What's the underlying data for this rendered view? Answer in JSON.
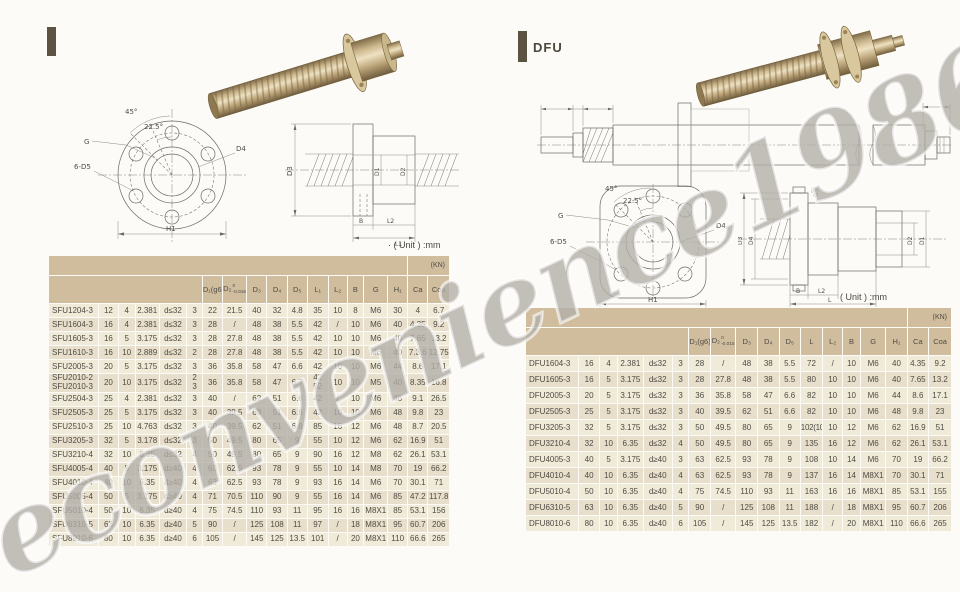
{
  "watermark": {
    "text": "econvenience1986"
  },
  "left_panel": {
    "unit_label": "· ( Unit ) :mm",
    "flange_drawing": {
      "angle_45": "45°",
      "angle_22_5": "22.5°",
      "g_label": "G",
      "holes_label": "6-D5",
      "d4_label": "D4",
      "h1_label": "H1"
    },
    "section_drawing": {
      "d3_label": "D3",
      "d1_label": "D1",
      "d2_label": "D2",
      "b_label": "B",
      "l2_label": "L2",
      "l1_label": "L1"
    },
    "table": {
      "kn_label": "(KN)",
      "columns": [
        "D₁(g6)",
        "D₂",
        "D₃",
        "D₄",
        "D₅",
        "L₁",
        "L₂",
        "B",
        "G",
        "H₁",
        "Ca",
        "Coa"
      ],
      "d2_tolerance": {
        "top": "0",
        "bottom": "-0.015"
      },
      "rows": [
        [
          "SFU1204-3",
          "12",
          "4",
          "2.381",
          "d≤32",
          "3",
          "22",
          "21.5",
          "40",
          "32",
          "4.8",
          "35",
          "10",
          "8",
          "M6",
          "30",
          "4",
          "6.7"
        ],
        [
          "SFU1604-3",
          "16",
          "4",
          "2.381",
          "d≤32",
          "3",
          "28",
          "/",
          "48",
          "38",
          "5.5",
          "42",
          "/",
          "10",
          "M6",
          "40",
          "4.35",
          "9.2"
        ],
        [
          "SFU1605-3",
          "16",
          "5",
          "3.175",
          "d≤32",
          "3",
          "28",
          "27.8",
          "48",
          "38",
          "5.5",
          "42",
          "10",
          "10",
          "M6",
          "40",
          "7.65",
          "13.2"
        ],
        [
          "SFU1610-3",
          "16",
          "10",
          "2.889",
          "d≤32",
          "2",
          "28",
          "27.8",
          "48",
          "38",
          "5.5",
          "42",
          "10",
          "10",
          "M6",
          "40",
          "7.3.6",
          "12.75"
        ],
        [
          "SFU2005-3",
          "20",
          "5",
          "3.175",
          "d≤32",
          "3",
          "36",
          "35.8",
          "58",
          "47",
          "6.6",
          "42",
          "10",
          "10",
          "M6",
          "44",
          "8.6",
          "17.1"
        ],
        [
          "SFU2010-2\nSFU2010-3",
          "20",
          "10",
          "3.175",
          "d≤32",
          "2\n3",
          "36",
          "35.8",
          "58",
          "47",
          "6.7",
          "42\n52",
          "10",
          "10",
          "M5",
          "40",
          "8.35",
          "16.8"
        ],
        [
          "SFU2504-3",
          "25",
          "4",
          "2.381",
          "d≤32",
          "3",
          "40",
          "/",
          "62",
          "51",
          "6.6",
          "42",
          "/",
          "10",
          "M6",
          "48",
          "9.1",
          "26.5"
        ],
        [
          "SFU2505-3",
          "25",
          "5",
          "3.175",
          "d≤32",
          "3",
          "40",
          "39.5",
          "63",
          "51",
          "6.6",
          "42",
          "10",
          "10",
          "M6",
          "48",
          "9.8",
          "23"
        ],
        [
          "SFU2510-3",
          "25",
          "10",
          "4.763",
          "d≤32",
          "3",
          "40",
          "39.5",
          "62",
          "51",
          "6.8",
          "85",
          "16",
          "12",
          "M6",
          "48",
          "8.7",
          "20.5"
        ],
        [
          "SFU3205-3",
          "32",
          "5",
          "3.178",
          "d≤32",
          "3",
          "50",
          "49.5",
          "80",
          "65",
          "9",
          "55",
          "10",
          "12",
          "M6",
          "62",
          "16.9",
          "51"
        ],
        [
          "SFU3210-4",
          "32",
          "10",
          "6.35",
          "d≤32",
          "4",
          "50",
          "49.5",
          "80",
          "65",
          "9",
          "90",
          "16",
          "12",
          "M8",
          "62",
          "26.1",
          "53.1"
        ],
        [
          "SFU4005-4",
          "40",
          "5",
          "3.175",
          "d≥40",
          "4",
          "63",
          "62.5",
          "93",
          "78",
          "9",
          "55",
          "10",
          "14",
          "M8",
          "70",
          "19",
          "66.2"
        ],
        [
          "SFU4010-4",
          "40",
          "10",
          "6.35",
          "d≥40",
          "4",
          "63",
          "62.5",
          "93",
          "78",
          "9",
          "93",
          "16",
          "14",
          "M6",
          "70",
          "30.1",
          "71"
        ],
        [
          "SFU5005-4",
          "50",
          "5",
          "3.175",
          "d≥40",
          "4",
          "71",
          "70.5",
          "110",
          "90",
          "9",
          "55",
          "16",
          "14",
          "M6",
          "85",
          "47.2",
          "117.8"
        ],
        [
          "SFU5010-4",
          "50",
          "10",
          "6.35",
          "d≥40",
          "4",
          "75",
          "74.5",
          "110",
          "93",
          "11",
          "95",
          "16",
          "16",
          "M8X1",
          "85",
          "53.1",
          "156"
        ],
        [
          "SFU6310-5",
          "63",
          "10",
          "6.35",
          "d≥40",
          "5",
          "90",
          "/",
          "125",
          "108",
          "11",
          "97",
          "/",
          "18",
          "M8X1",
          "95",
          "60.7",
          "206"
        ],
        [
          "SFU8010-6",
          "80",
          "10",
          "6.35",
          "d≥40",
          "6",
          "105",
          "/",
          "145",
          "125",
          "13.5",
          "101",
          "/",
          "20",
          "M8X1",
          "110",
          "66.6",
          "265"
        ]
      ]
    }
  },
  "right_panel": {
    "title": "DFU",
    "unit_label": "( Unit ) :mm",
    "flange_drawing": {
      "angle_45": "45°",
      "angle_22_5": "22.5°",
      "g_label": "G",
      "holes_label": "6-D5",
      "d4_label": "D4",
      "h1_label": "H1"
    },
    "section_drawing": {
      "d3_label": "D3",
      "d4_label": "D4",
      "d5_label": "D5",
      "d2_label": "D2",
      "d1_label": "D1",
      "b_label": "B",
      "l2_label": "L2",
      "l_label": "L"
    },
    "table": {
      "kn_label": "(KN)",
      "columns": [
        "D₁(g6)",
        "D₂",
        "D₃",
        "D₄",
        "D₅",
        "L",
        "L₂",
        "B",
        "G",
        "H₁",
        "Ca",
        "Coa"
      ],
      "d2_tolerance": {
        "top": "0",
        "bottom": "-0.015"
      },
      "rows": [
        [
          "DFU1604-3",
          "16",
          "4",
          "2.381",
          "d≤32",
          "3",
          "28",
          "/",
          "48",
          "38",
          "5.5",
          "72",
          "/",
          "10",
          "M6",
          "40",
          "4.35",
          "9.2"
        ],
        [
          "DFU1605-3",
          "16",
          "5",
          "3.175",
          "d≤32",
          "3",
          "28",
          "27.8",
          "48",
          "38",
          "5.5",
          "80",
          "10",
          "10",
          "M6",
          "40",
          "7.65",
          "13.2"
        ],
        [
          "DFU2005-3",
          "20",
          "5",
          "3.175",
          "d≤32",
          "3",
          "36",
          "35.8",
          "58",
          "47",
          "6.6",
          "82",
          "10",
          "10",
          "M6",
          "44",
          "8.6",
          "17.1"
        ],
        [
          "DFU2505-3",
          "25",
          "5",
          "3.175",
          "d≤32",
          "3",
          "40",
          "39.5",
          "62",
          "51",
          "6.6",
          "82",
          "10",
          "10",
          "M6",
          "48",
          "9.8",
          "23"
        ],
        [
          "DFU3205-3",
          "32",
          "5",
          "3.175",
          "d≤32",
          "3",
          "50",
          "49.5",
          "80",
          "65",
          "9",
          "102(106)",
          "10",
          "12",
          "M6",
          "62",
          "16.9",
          "51"
        ],
        [
          "DFU3210-4",
          "32",
          "10",
          "6.35",
          "d≤32",
          "4",
          "50",
          "49.5",
          "80",
          "65",
          "9",
          "135",
          "16",
          "12",
          "M6",
          "62",
          "26.1",
          "53.1"
        ],
        [
          "DFU4005-3",
          "40",
          "5",
          "3.175",
          "d≥40",
          "3",
          "63",
          "62.5",
          "93",
          "78",
          "9",
          "108",
          "10",
          "14",
          "M6",
          "70",
          "19",
          "66.2"
        ],
        [
          "DFU4010-4",
          "40",
          "10",
          "6.35",
          "d≥40",
          "4",
          "63",
          "62.5",
          "93",
          "78",
          "9",
          "137",
          "16",
          "14",
          "M8X1",
          "70",
          "30.1",
          "71"
        ],
        [
          "DFU5010-4",
          "50",
          "10",
          "6.35",
          "d≥40",
          "4",
          "75",
          "74.5",
          "110",
          "93",
          "11",
          "163",
          "16",
          "16",
          "M8X1",
          "85",
          "53.1",
          "155"
        ],
        [
          "DFU6310-5",
          "63",
          "10",
          "6.35",
          "d≥40",
          "5",
          "90",
          "/",
          "125",
          "108",
          "11",
          "188",
          "/",
          "18",
          "M8X1",
          "95",
          "60.7",
          "206"
        ],
        [
          "DFU8010-6",
          "80",
          "10",
          "6.35",
          "d≥40",
          "6",
          "105",
          "/",
          "145",
          "125",
          "13.5",
          "182",
          "/",
          "20",
          "M8X1",
          "110",
          "66.6",
          "265"
        ]
      ]
    }
  }
}
